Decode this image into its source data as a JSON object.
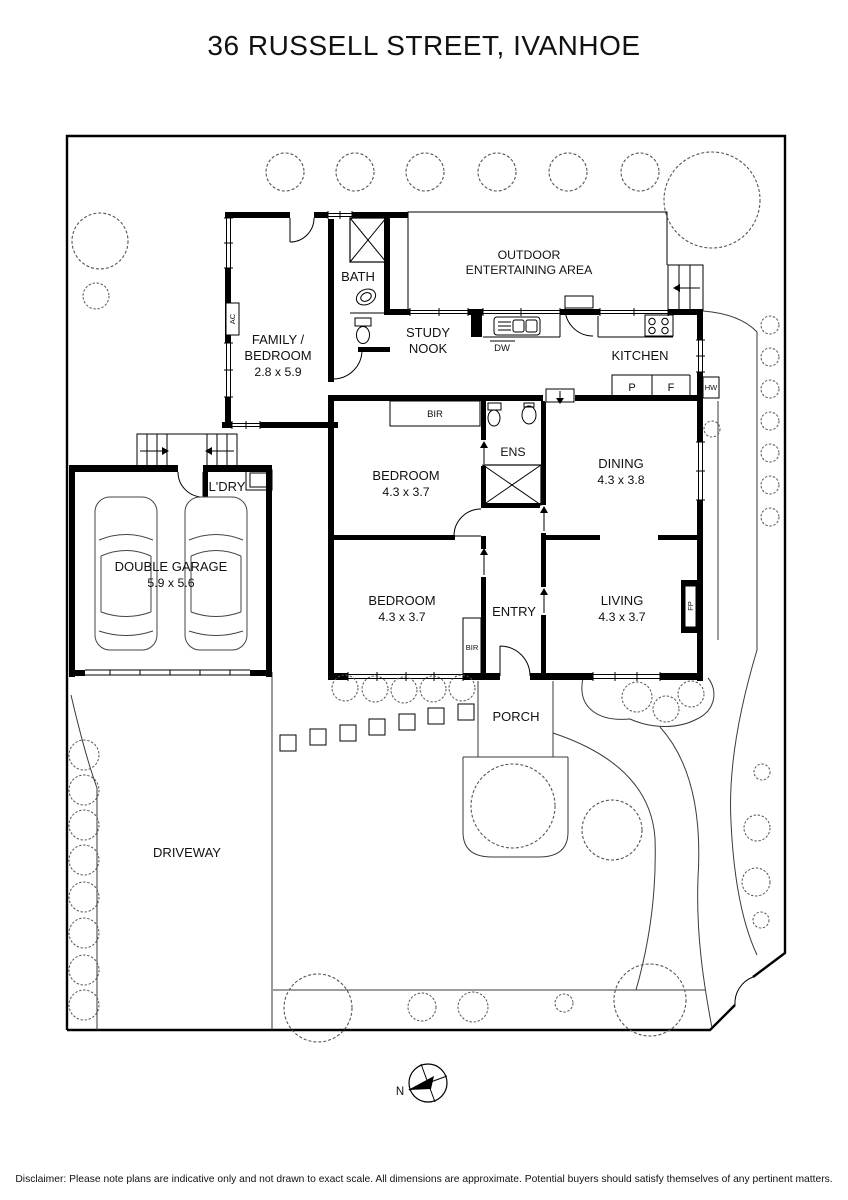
{
  "title": "36 RUSSELL STREET, IVANHOE",
  "rooms": {
    "family": {
      "line1": "FAMILY /",
      "line2": "BEDROOM",
      "dims": "2.8 x 5.9"
    },
    "bath": {
      "label": "BATH"
    },
    "study": {
      "line1": "STUDY",
      "line2": "NOOK"
    },
    "outdoor": {
      "line1": "OUTDOOR",
      "line2": "ENTERTAINING AREA"
    },
    "kitchen": {
      "label": "KITCHEN"
    },
    "bedroom1": {
      "label": "BEDROOM",
      "dims": "4.3 x 3.7"
    },
    "ens": {
      "label": "ENS"
    },
    "dining": {
      "label": "DINING",
      "dims": "4.3 x 3.8"
    },
    "bedroom2": {
      "label": "BEDROOM",
      "dims": "4.3 x 3.7"
    },
    "entry": {
      "label": "ENTRY"
    },
    "living": {
      "label": "LIVING",
      "dims": "4.3 x 3.7"
    },
    "laundry": {
      "label": "L'DRY"
    },
    "garage": {
      "label": "DOUBLE GARAGE",
      "dims": "5.9 x 5.6"
    },
    "porch": {
      "label": "PORCH"
    },
    "driveway": {
      "label": "DRIVEWAY"
    }
  },
  "fixtures": {
    "bir1": "BIR",
    "bir2": "BIR",
    "dw": "DW",
    "pantry": "P",
    "fridge": "F",
    "hot_water": "HW",
    "fireplace": "FP",
    "air_con": "AC"
  },
  "compass": {
    "north": "N"
  },
  "disclaimer": "Disclaimer: Please note plans are indicative only and not drawn to exact scale. All dimensions are approximate. Potential buyers should satisfy themselves of any pertinent matters.",
  "colors": {
    "line": "#000000",
    "background": "#ffffff"
  }
}
